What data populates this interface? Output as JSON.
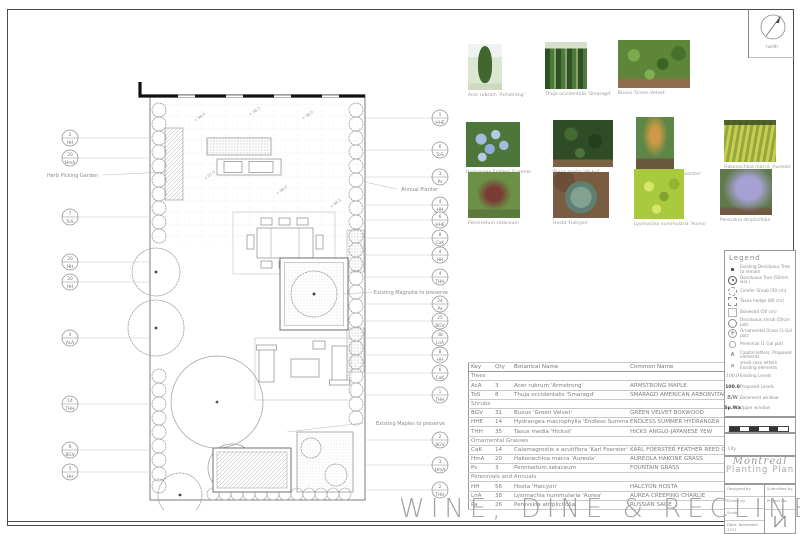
{
  "sheet_title": "WINE, DINE & RECLINE",
  "north_label": "north",
  "photos": [
    {
      "caption": "Acer rubrum 'Armstrong'"
    },
    {
      "caption": "Thuja occidentalis 'Smaragd'"
    },
    {
      "caption": "Buxus 'Green Velvet'"
    },
    {
      "caption": "Hydrangea Endless Summer"
    },
    {
      "caption": "Taxus media 'Hicksii'"
    },
    {
      "caption": "Calamagrostis 'Karl Foerster'"
    },
    {
      "caption": "Hakonechloa macra 'Aureola'"
    },
    {
      "caption": "Pennisetum setaceum"
    },
    {
      "caption": "Hosta 'Halcyon'"
    },
    {
      "caption": "Lysimachia nummularia 'Aurea'"
    },
    {
      "caption": "Perovskia atriplicifolia"
    }
  ],
  "plan": {
    "labels": {
      "herb_garden": "Herb Picking Garden",
      "annual_planter": "Annual Planter",
      "magnolia": "Existing Magnolia to preserve",
      "maples": "Existing Maples to preserve"
    },
    "levels": [
      "+ 98.0",
      "+ 98.5",
      "+ 98.0",
      "+ 97.5",
      "+ 98.0",
      "+ 98.5"
    ],
    "callouts_left": [
      {
        "qty": "2",
        "key": "HH"
      },
      {
        "qty": "20",
        "key": "HmA"
      },
      {
        "qty": "7",
        "key": "ToS"
      },
      {
        "qty": "20",
        "key": "HH"
      },
      {
        "qty": "20",
        "key": "HH"
      },
      {
        "qty": "4",
        "key": "AcA"
      },
      {
        "qty": "14",
        "key": "THH"
      },
      {
        "qty": "6",
        "key": "BGV"
      },
      {
        "qty": "5",
        "key": "HH"
      }
    ],
    "callouts_right": [
      {
        "qty": "1",
        "key": "HHE"
      },
      {
        "qty": "6",
        "key": "ToS"
      },
      {
        "qty": "3",
        "key": "Ps"
      },
      {
        "qty": "4",
        "key": "HH"
      },
      {
        "qty": "6",
        "key": "HHE"
      },
      {
        "qty": "8",
        "key": "CaK"
      },
      {
        "qty": "4",
        "key": "HH"
      },
      {
        "qty": "4",
        "key": "THH"
      },
      {
        "qty": "24",
        "key": "Pa"
      },
      {
        "qty": "25",
        "key": "BGV"
      },
      {
        "qty": "38",
        "key": "LnA"
      },
      {
        "qty": "8",
        "key": "HH"
      },
      {
        "qty": "6",
        "key": "CaK"
      },
      {
        "qty": "1",
        "key": "THH"
      },
      {
        "qty": "2",
        "key": "BGV"
      },
      {
        "qty": "3",
        "key": "HmA"
      },
      {
        "qty": "2",
        "key": "THH"
      }
    ]
  },
  "schedule": {
    "headers": [
      "Key",
      "Qty",
      "Botanical Name",
      "Common Name"
    ],
    "sections": [
      {
        "name": "Trees",
        "rows": [
          [
            "AcA",
            "3",
            "Acer rubrum 'Armstrong'",
            "ARMSTRONG MAPLE"
          ],
          [
            "ToS",
            "8",
            "Thuja occidentalis 'Smaragd'",
            "SMARAGD AMERICAN ARBORVITAE"
          ]
        ]
      },
      {
        "name": "Shrubs",
        "rows": [
          [
            "BGV",
            "31",
            "Buxus 'Green Velvet'",
            "GREEN VELVET BOXWOOD"
          ],
          [
            "HHE",
            "14",
            "Hydrangea macrophylla 'Endless Summer'",
            "ENDLESS SUMMER HYDRANGEA"
          ],
          [
            "THH",
            "35",
            "Taxus media 'Hicksii'",
            "HICKS ANGLO-JAPANESE YEW"
          ]
        ]
      },
      {
        "name": "Ornamental Grasses",
        "rows": [
          [
            "CaK",
            "14",
            "Calamagrostis x acutiflora 'Karl Foerster'",
            "KARL FOERSTER FEATHER REED GRASS"
          ],
          [
            "HmA",
            "20",
            "Hakonechloa macra 'Aureola'",
            "AUREOLA HAKONE GRASS"
          ],
          [
            "Ps",
            "3",
            "Pennisetum setaceum",
            "FOUNTAIN GRASS"
          ]
        ]
      },
      {
        "name": "Perennials and Annuals",
        "rows": [
          [
            "HH",
            "56",
            "Hosta 'Halcyon'",
            "HALCYON HOSTA"
          ],
          [
            "LnA",
            "38",
            "Lysimachia nummularia 'Aurea'",
            "AUREA CREEPING CHARLIE"
          ],
          [
            "Pa",
            "26",
            "Perovskia atriplicifolia",
            "RUSSIAN SAGE"
          ]
        ]
      }
    ]
  },
  "legend": {
    "title": "Legend",
    "items": [
      {
        "symbol": "dot-icon",
        "label": "Existing Deciduous Tree to remain"
      },
      {
        "symbol": "deciduous-tree-icon",
        "label": "Deciduous Tree (50mm w.b.)"
      },
      {
        "symbol": "conifer-shrub-icon",
        "label": "Conifer Shrub (50 cm)"
      },
      {
        "symbol": "taxus-hedge-icon",
        "label": "Taxus hedge (80 cm)"
      },
      {
        "symbol": "boxwood-icon",
        "label": "Boxwood (50 cm)"
      },
      {
        "symbol": "deciduous-shrub-icon",
        "label": "Deciduous shrub (50cm pot)"
      },
      {
        "symbol": "ornamental-grass-icon",
        "label": "Ornamental Grass (1 Gal pot)"
      },
      {
        "symbol": "perennial-icon",
        "label": "Perennial (1 Gal pot)"
      },
      {
        "symbol": "A",
        "label": "Capital letters: Proposed elements"
      },
      {
        "symbol": "a",
        "label": "small case letters: Existing elements"
      },
      {
        "symbol": "100.0",
        "label": "Existing Levels"
      },
      {
        "symbol": "100.0",
        "label": "Proposed Levels"
      },
      {
        "symbol": "B/W",
        "label": "Basement window"
      },
      {
        "symbol": "Sp.Wa",
        "label": "Upper window"
      }
    ]
  },
  "titleblock": {
    "scale_label": "Scale",
    "city_label": "City",
    "city": "Montreal",
    "drawing_title": "Planting Plan",
    "designed_by": "Designed by",
    "drawn_by": "Drawn by",
    "scale_field": "Scale",
    "date_label": "Date:",
    "date": "November 2017",
    "submitted_by": "Submitted by",
    "project_no": "Project No."
  }
}
